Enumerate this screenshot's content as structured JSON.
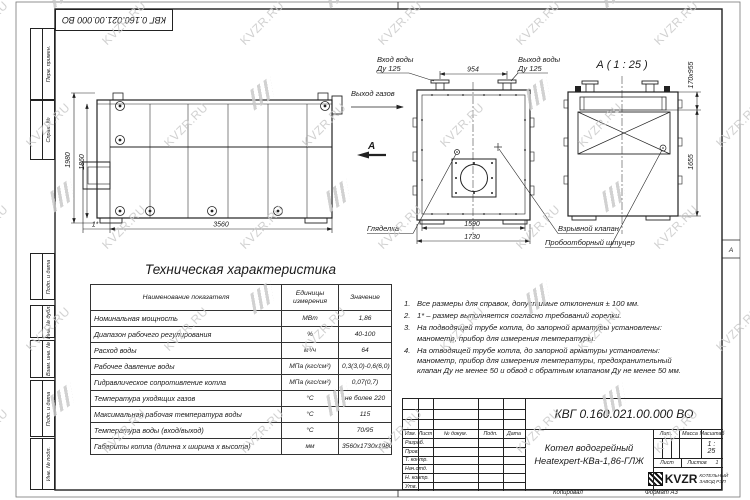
{
  "doc": {
    "designation": "КВГ 0.160.021.00.000 ВО",
    "product_name_line1": "Котел водогрейный",
    "product_name_line2": "Heatexpert-КВа-1,86-ГЛЖ",
    "scale_value": "1 : 25",
    "sheets_value": "1",
    "copied_label": "Копировал",
    "format_label": "Формат А3",
    "zone_letter": "А",
    "company_logo": "KVZR",
    "company_line1": "КОТЕЛЬНЫЙ",
    "company_line2": "ЗАВОД РЭП"
  },
  "title_block": {
    "header_cols": [
      "Изм.",
      "Лист",
      "№ докум.",
      "Подп.",
      "Дата"
    ],
    "rows": [
      "Разраб.",
      "Пров.",
      "Т. контр.",
      "Нач.отд.",
      "Н. контр.",
      "Утв."
    ],
    "lit_label": "Лит.",
    "mass_label": "Масса",
    "scale_label": "Масштаб",
    "sheet_label": "Лист",
    "sheets_label": "Листов"
  },
  "margin_stamps": [
    "Перв. примен.",
    "Справ. №",
    "Подп. и дата",
    "Инв. № дубл.",
    "Взам. инв. №",
    "Подп. и дата",
    "Инв. № подл."
  ],
  "views": {
    "side": {
      "dim_height_outer": "1980",
      "dim_height_inner": "1860",
      "dim_length": "3560",
      "dim_burner": "1*"
    },
    "front": {
      "label_water_in_1": "Вход воды",
      "label_water_in_2": "Ду 125",
      "label_water_out_1": "Выход воды",
      "label_water_out_2": "Ду 125",
      "dim_nozzle_spacing": "954",
      "label_gas_out": "Выход газов",
      "view_arrow_letter": "А",
      "label_sight_glass": "Гляделка",
      "dim_width_inner": "1590",
      "dim_width_outer": "1730",
      "label_explosion_valve": "Взрывной клапан",
      "label_sampling_fitting": "Пробоотборный штуцер"
    },
    "view_a": {
      "title": "А ( 1 : 25 )",
      "dim_slot": "170х955",
      "dim_height": "1655"
    }
  },
  "table": {
    "title": "Техническая характеристика",
    "headers": [
      "Наименование показателя",
      "Единицы измерения",
      "Значение"
    ],
    "rows": [
      [
        "Номинальная мощность",
        "МВт",
        "1,86"
      ],
      [
        "Диапазон рабочего регулирования",
        "%",
        "40-100"
      ],
      [
        "Расход воды",
        "м³/ч",
        "64"
      ],
      [
        "Рабочее давление воды",
        "МПа (кгс/см²)",
        "0,3(3,0)-0,6(6,0)"
      ],
      [
        "Гидравлическое сопротивление котла",
        "МПа (кгс/см²)",
        "0,07(0,7)"
      ],
      [
        "Температура уходящих газов",
        "°С",
        "не более 220"
      ],
      [
        "Максимальная рабочая температура воды",
        "°С",
        "115"
      ],
      [
        "Температура воды (вход/выход)",
        "°С",
        "70/95"
      ],
      [
        "Габариты котла (длинна х ширина х высота)",
        "мм",
        "3560х1730х1980"
      ]
    ]
  },
  "notes_numbers": [
    "1.",
    "2.",
    "3.",
    "4."
  ],
  "notes": [
    "Все размеры для справок, допустимые отклонения ± 100 мм.",
    "1* – размер выполняется согласно требований горелки.",
    "На подводящей трубе котла, до запорной арматуры установлены: манометр, прибор для измерения температуры.",
    "На отводящей трубе котла, до запорной арматуры установлены: манометр, прибор для измерения температуры, предохранительный клапан Ду не менее 50 и обвод с обратным клапаном Ду не менее 50 мм."
  ],
  "watermark": {
    "text": "KVZR.RU",
    "color": "#c9c9c9"
  }
}
